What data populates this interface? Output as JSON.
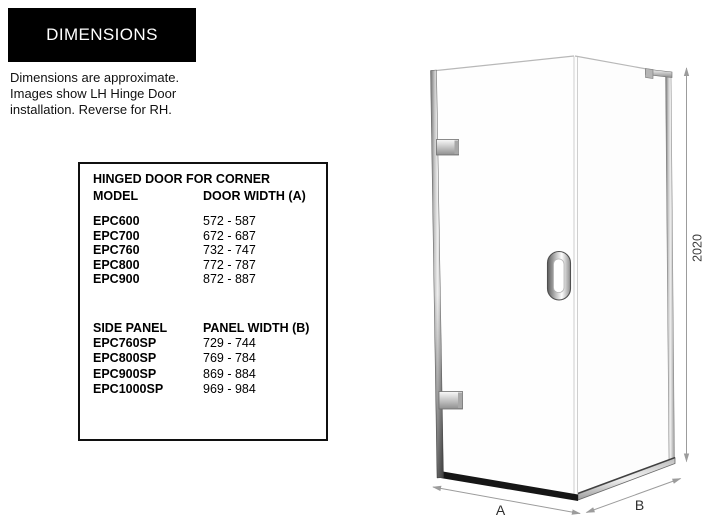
{
  "header": {
    "title": "DIMENSIONS"
  },
  "intro": {
    "text": "Dimensions are approximate.\nImages show LH Hinge Door\ninstallation. Reverse for RH."
  },
  "spec_table": {
    "title": "HINGED DOOR FOR CORNER",
    "door_section": {
      "col_model": "MODEL",
      "col_width": "DOOR WIDTH (A)",
      "rows": [
        {
          "model": "EPC600",
          "width": "572 - 587"
        },
        {
          "model": "EPC700",
          "width": "672 - 687"
        },
        {
          "model": "EPC760",
          "width": "732 - 747"
        },
        {
          "model": "EPC800",
          "width": "772 - 787"
        },
        {
          "model": "EPC900",
          "width": "872 - 887"
        }
      ]
    },
    "panel_section": {
      "col_model": "SIDE PANEL",
      "col_width": "PANEL WIDTH (B)",
      "rows": [
        {
          "model": "EPC760SP",
          "width": "729 - 744"
        },
        {
          "model": "EPC800SP",
          "width": "769 - 784"
        },
        {
          "model": "EPC900SP",
          "width": "869 - 884"
        },
        {
          "model": "EPC1000SP",
          "width": "969 - 984"
        }
      ]
    }
  },
  "diagram": {
    "height_label": "2020",
    "door_width_label": "A",
    "panel_width_label": "B"
  },
  "colors": {
    "header_bg": "#000000",
    "header_text": "#ffffff",
    "body_text": "#111111",
    "dimension_line": "#9c9c9c",
    "chrome_light": "#efefef",
    "chrome_dark": "#707070",
    "rail_black": "#161616"
  }
}
